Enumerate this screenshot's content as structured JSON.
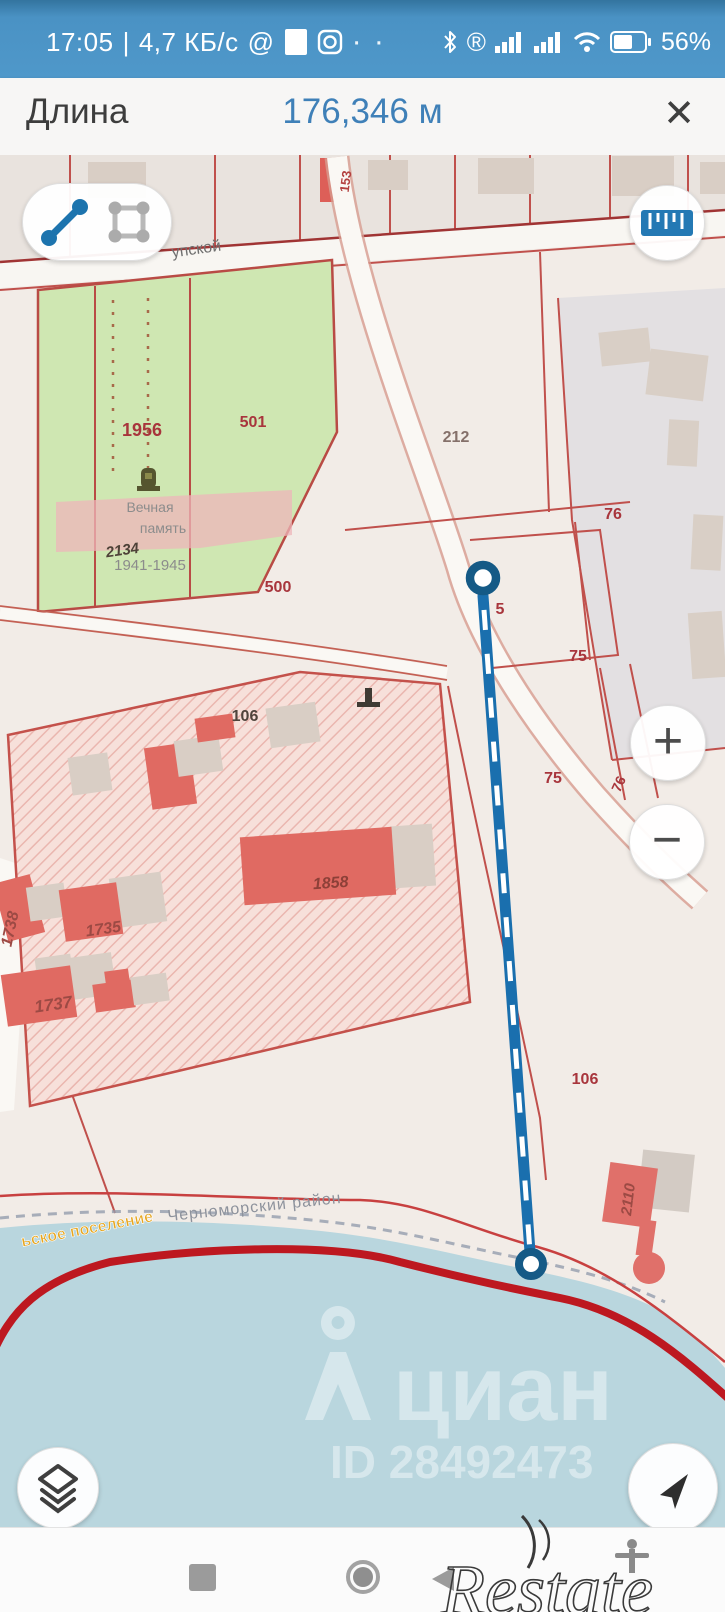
{
  "status_bar": {
    "time": "17:05",
    "divider": "|",
    "speed": "4,7 КБ/с",
    "at_symbol": "@",
    "dots": "· ·",
    "registered": "®",
    "battery_percent": "56%"
  },
  "header": {
    "title": "Длина",
    "value": "176,346 м",
    "close": "✕"
  },
  "controls": {
    "zoom_in": "+",
    "zoom_out": "−"
  },
  "map": {
    "street": "упской",
    "labels": [
      "153",
      "1956",
      "501",
      "212",
      "76",
      "Вечная",
      "память",
      "2134",
      "1941-1945",
      "500",
      "5",
      "75",
      "75",
      "76",
      "106",
      "1858",
      "1735",
      "1738",
      "1737",
      "106",
      "2110",
      "Черноморский район",
      "ьское поселение"
    ],
    "watermark": {
      "brand": "циан",
      "id_label": "ID 28492473"
    }
  },
  "nav_bar": {
    "watermark": "Restate"
  },
  "colors": {
    "status_bar": "#4a92c4",
    "header_value_blue": "#3f80b8",
    "measure_line": "#1a6fae",
    "cadastral_red": "#c0504c",
    "boundary_red": "#bd1820",
    "park_green": "#cfe7b2",
    "water": "#b9d6de",
    "building_red": "#e06a62",
    "building_beige": "#d9cec5"
  }
}
